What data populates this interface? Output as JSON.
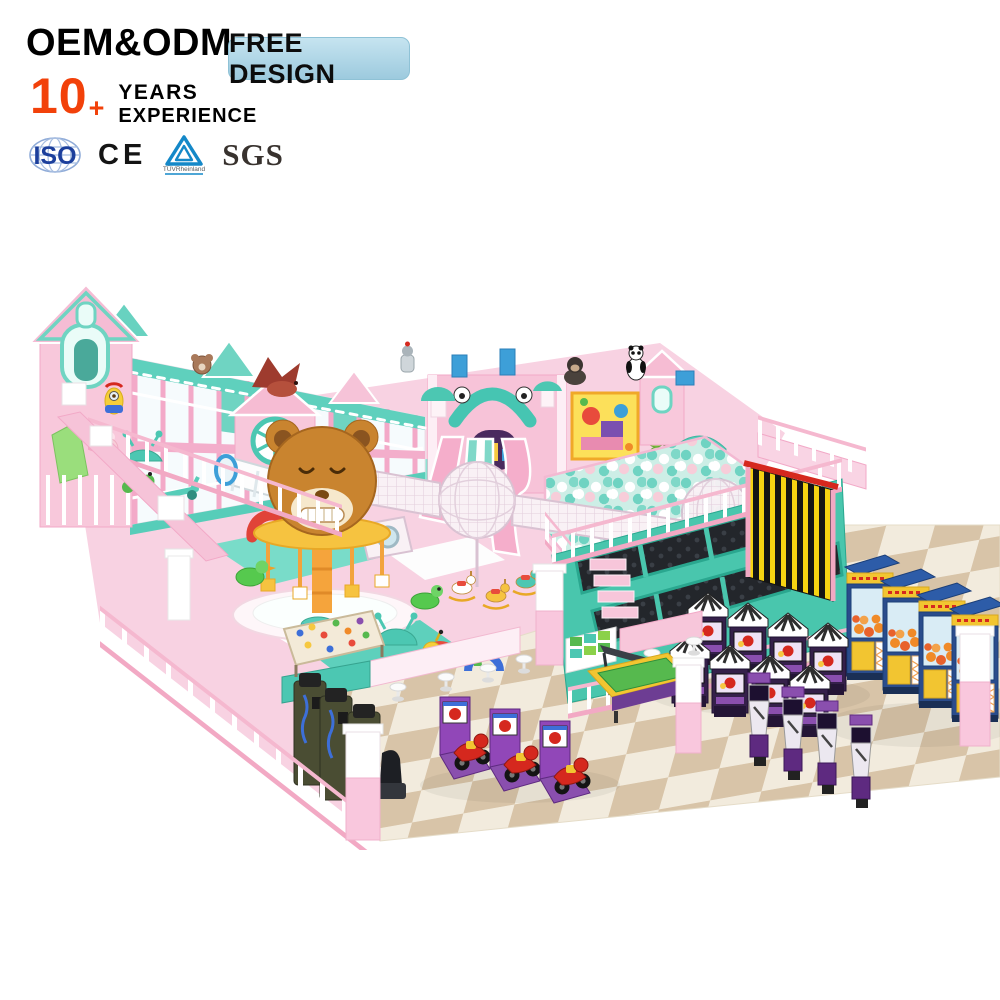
{
  "header": {
    "oem_text": "OEM&ODM",
    "free_design_label": "FREE DESIGN",
    "years_value": "10",
    "years_plus": "+",
    "years_label": "YEARS",
    "experience_label": "EXPERIENCE"
  },
  "certifications": {
    "iso": "ISO",
    "ce": "CE",
    "tuv": "TÜVRheinland",
    "sgs": "SGS"
  },
  "palette": {
    "accent_red": "#f2410a",
    "badge_blue": "#a9d2e4",
    "text_black": "#0c0c0c",
    "playground_pink": "#f6c3d8",
    "playground_mint": "#5fd0bd",
    "floor_tan": "#d8c4a8",
    "floor_cream": "#f2ebdd",
    "ball_teal": "#6fd3c2",
    "bear_brown": "#c9842f",
    "arcade_purple": "#8a4fae",
    "claw_navy": "#2a4c8c",
    "claw_yellow": "#f2c531",
    "trampoline_black": "#23262b",
    "stripe_yellow": "#f5d312"
  },
  "scene": {
    "alt": "Pastel pink and mint indoor soft playground render with house facades, teddy bear carousel, wire mesh spheres, triple slide castle, ball pit, trampoline court, striped climbing wall, claw machines, arcade cabinets, kiddie motorcycle rides, pool table and checkered floor",
    "elements": [
      "house-facade towers",
      "two-story soft play gallery",
      "barn gable with wheel window",
      "teddy-bear carousel",
      "wire mesh spheres and tunnels",
      "triple slide castle",
      "ball pit",
      "elephant slide",
      "trampoline court",
      "striped climbing wall",
      "claw machines",
      "arcade cabinets",
      "shooting game machines",
      "motorcycle kiddie rides",
      "punch machines",
      "pool table",
      "play counters with stools",
      "sand play table",
      "toddler ride-on toys",
      "pink safety fences and pillars",
      "checkered floor"
    ]
  }
}
